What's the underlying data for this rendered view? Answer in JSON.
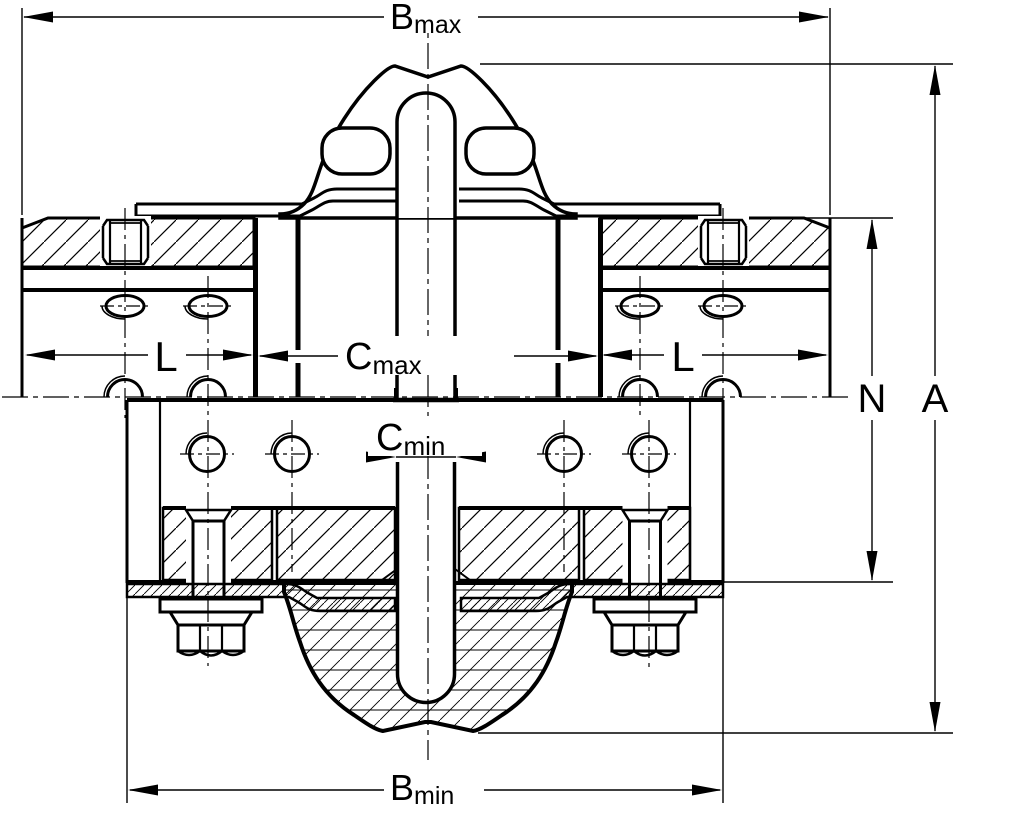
{
  "drawing": {
    "kind": "technical-section-drawing",
    "subject": "flexible-tyre-coupling-cross-section",
    "colors": {
      "line": "#000000",
      "background": "#ffffff"
    },
    "dimensions": {
      "b_max": {
        "main": "B",
        "sub": "max"
      },
      "b_min": {
        "main": "B",
        "sub": "min"
      },
      "c_max": {
        "main": "C",
        "sub": "max"
      },
      "c_min": {
        "main": "C",
        "sub": "min"
      },
      "l_left": {
        "main": "L",
        "sub": ""
      },
      "l_right": {
        "main": "L",
        "sub": ""
      },
      "n": {
        "main": "N",
        "sub": ""
      },
      "a": {
        "main": "A",
        "sub": ""
      }
    }
  }
}
